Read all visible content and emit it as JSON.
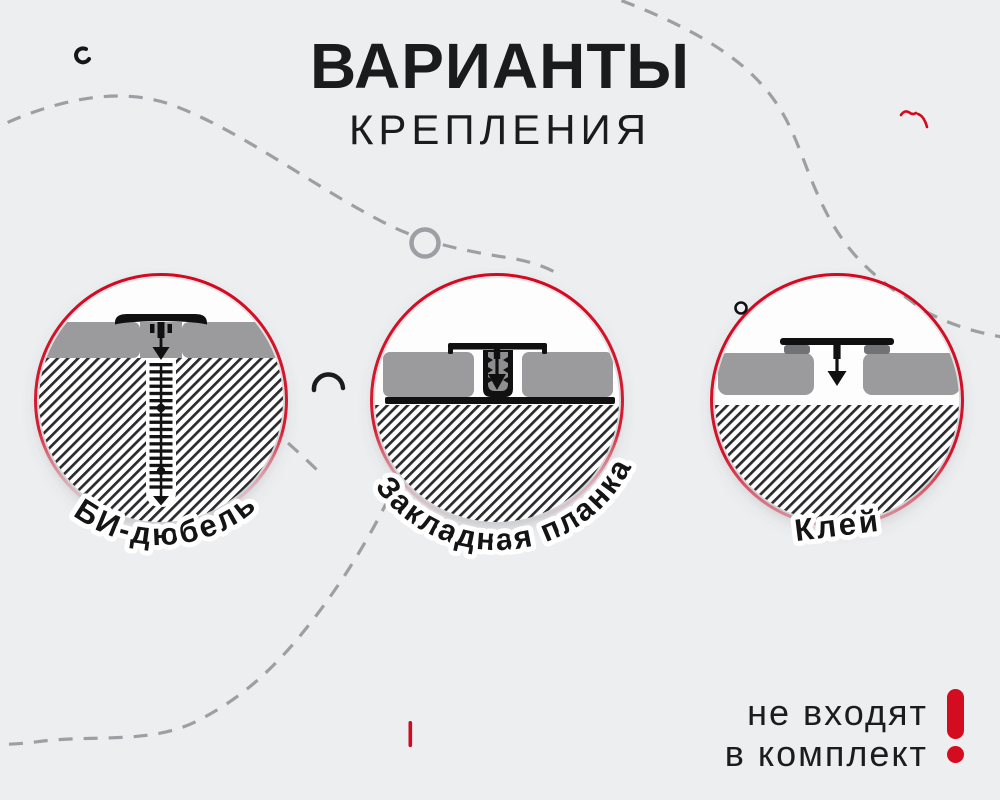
{
  "page": {
    "background": "#edeef0"
  },
  "title": {
    "line1": "ВАРИАНТЫ",
    "line2": "КРЕПЛЕНИЯ"
  },
  "options": [
    {
      "id": "bi-dowel",
      "label": "БИ-дюбель"
    },
    {
      "id": "mounting-plate",
      "label": "Закладная планка"
    },
    {
      "id": "glue",
      "label": "Клей"
    }
  ],
  "footer": {
    "line1": "не входят",
    "line2": "в комплект",
    "mark": "!"
  },
  "colors": {
    "accent_red": "#d30920",
    "ink": "#1a1b1d",
    "panel_gray": "#9b9b9d",
    "glue_pad_gray": "#717275",
    "hatch_ink": "#2b2b2e",
    "dash_gray": "#9ca0a4",
    "circle_white": "#fdfdfe"
  },
  "icons": [
    "down-arrow-icon",
    "exclamation-icon",
    "dashed-curve",
    "ring-circle",
    "small-circle-doodle",
    "arc-doodle",
    "comma-doodle",
    "red-squiggle",
    "red-tick"
  ]
}
